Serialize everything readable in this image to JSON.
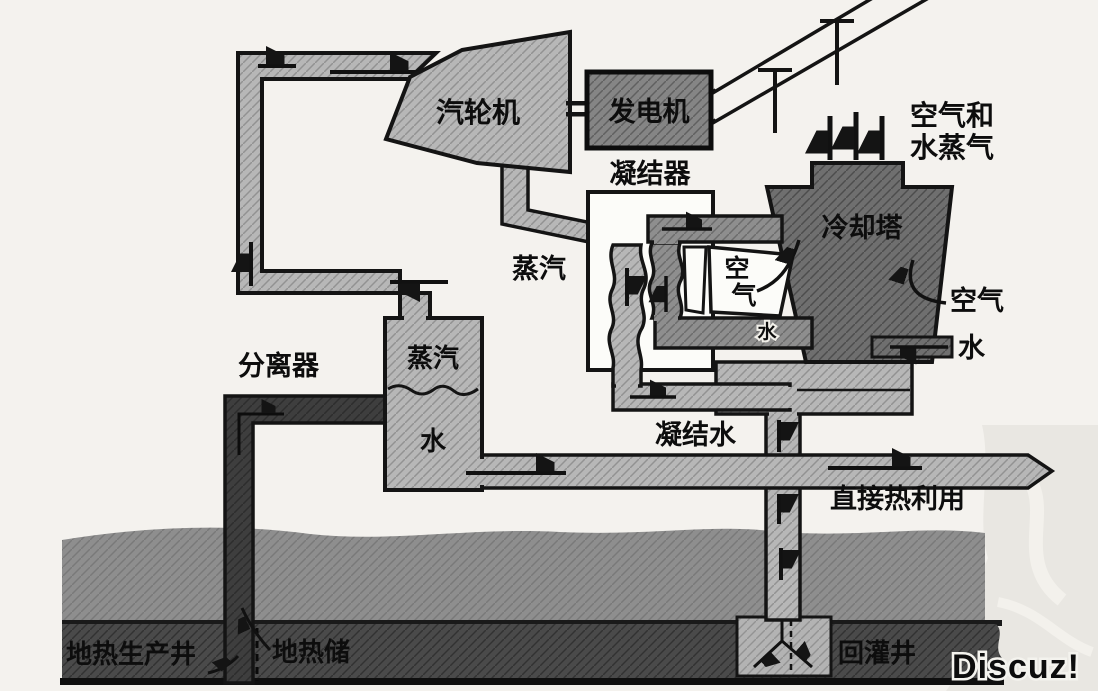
{
  "labels": {
    "turbine": "汽轮机",
    "generator": "发电机",
    "condenser": "凝结器",
    "steam_pipe": "蒸汽",
    "separator": "分离器",
    "separator_steam": "蒸汽",
    "separator_water": "水",
    "cooling_tower": "冷却塔",
    "air_tower_chars": [
      "空",
      "气"
    ],
    "water_small": "水",
    "air_right": "空气",
    "water_right": "水",
    "air_vapor_lines": [
      "空气和",
      "水蒸气"
    ],
    "condensate": "凝结水",
    "direct_heat_use": "直接热利用",
    "production_well": "地热生产井",
    "geothermal_reservoir": "地热储",
    "injection_well": "回灌井",
    "watermark": "Discuz!"
  },
  "colors": {
    "paper": "#f4f2ee",
    "pipe_light": "#b7b7b7",
    "pipe_mid": "#8e8e8e",
    "generator_box": "#858585",
    "cooling_tower": "#6f6f6f",
    "ground": "#8e8e8e",
    "reservoir": "#4a4a4a",
    "well_pipe": "#3e3e3e",
    "injection_block": "#b3b3b3",
    "condenser_bg": "#fcfcf9",
    "air_box": "#fcfcf9",
    "outline": "#141414",
    "watermark_area": "#e9e7e2",
    "watermark_text": "#9c9b98"
  }
}
